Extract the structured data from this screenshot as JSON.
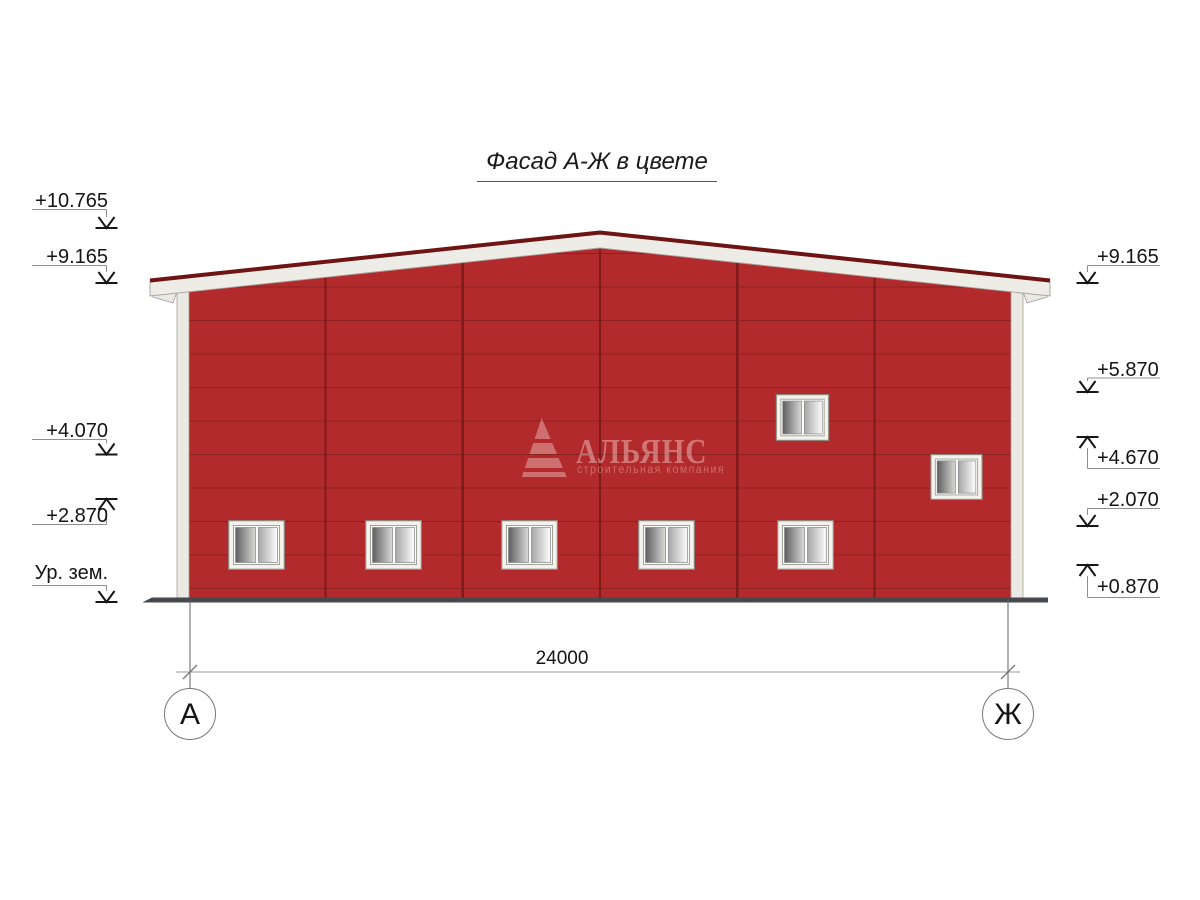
{
  "drawing": {
    "title": "Фасад А-Ж в цвете",
    "dimension_total": "24000",
    "axis_left": "А",
    "axis_right": "Ж"
  },
  "levels_left": [
    {
      "label": "+10.765",
      "direction": "down"
    },
    {
      "label": "+9.165",
      "direction": "down"
    },
    {
      "label": "+4.070",
      "direction": "down"
    },
    {
      "label": "+2.870",
      "direction": "up"
    },
    {
      "label": "Ур. зем.",
      "direction": "down"
    }
  ],
  "levels_right": [
    {
      "label": "+9.165",
      "direction": "down"
    },
    {
      "label": "+5.870",
      "direction": "down"
    },
    {
      "label": "+4.670",
      "direction": "up"
    },
    {
      "label": "+2.070",
      "direction": "down"
    },
    {
      "label": "+0.870",
      "direction": "up"
    }
  ],
  "watermark": {
    "brand": "АЛЬЯНС",
    "tagline": "строительная компания"
  },
  "colors": {
    "facade_red": "#b22a2b",
    "panel_line_red": "#8c2020",
    "roof_edge_dark_red": "#6f1414",
    "trim_white": "#ebe9e3",
    "ground_gray": "#45484c"
  }
}
